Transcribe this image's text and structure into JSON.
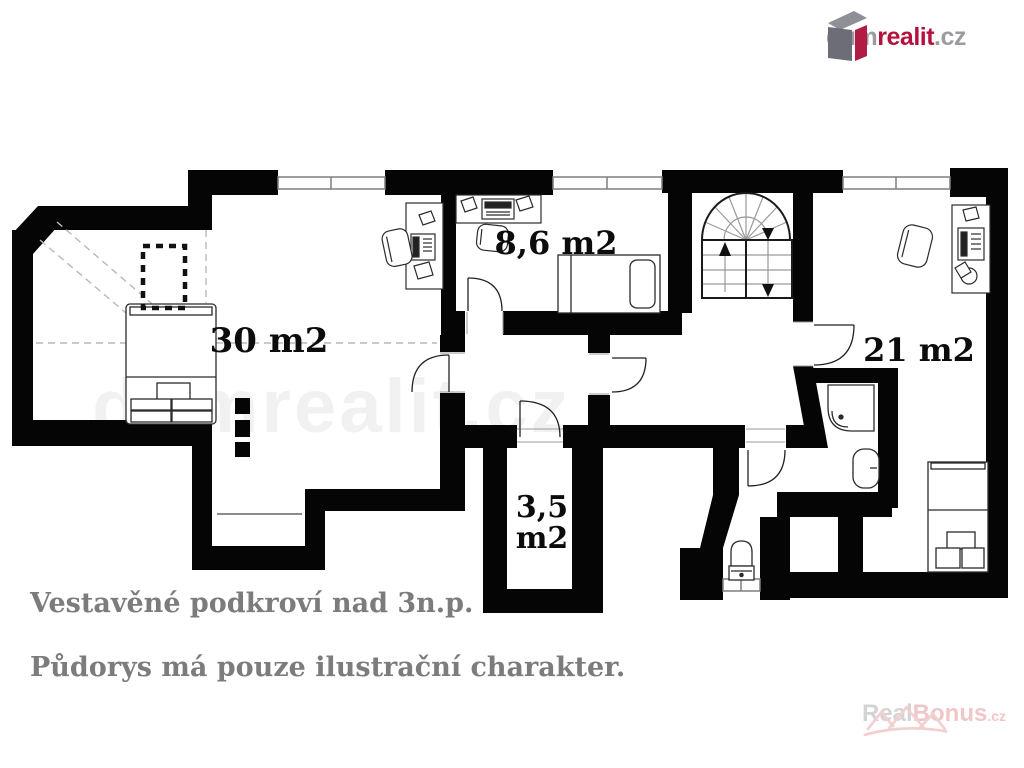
{
  "header": {
    "logo": {
      "prefix": "dum",
      "accent": "realit",
      "suffix": ".cz"
    }
  },
  "plan": {
    "watermark": "dumrealit.cz",
    "rooms": [
      {
        "name": "bedroom-left",
        "area_label": "30 m2"
      },
      {
        "name": "room-middle",
        "area_label": "8,6 m2"
      },
      {
        "name": "closet",
        "area_label_line1": "3,5",
        "area_label_line2": "m2"
      },
      {
        "name": "bedroom-right",
        "area_label": "21 m2"
      }
    ]
  },
  "captions": {
    "line1": "Vestavěné podkroví nad 3n.p.",
    "line2": "Půdorys má pouze ilustrační charakter."
  },
  "footer_watermark": {
    "prefix": "Real",
    "accent": "Bonus",
    "suffix": ".cz"
  },
  "colors": {
    "wall": "#050505",
    "caption_gray": "#7c7c7c",
    "logo_gray": "#9c9ca0",
    "logo_red": "#b3123f",
    "bonus_gray": "#d4d4d4",
    "bonus_pink": "#eec8c8"
  }
}
